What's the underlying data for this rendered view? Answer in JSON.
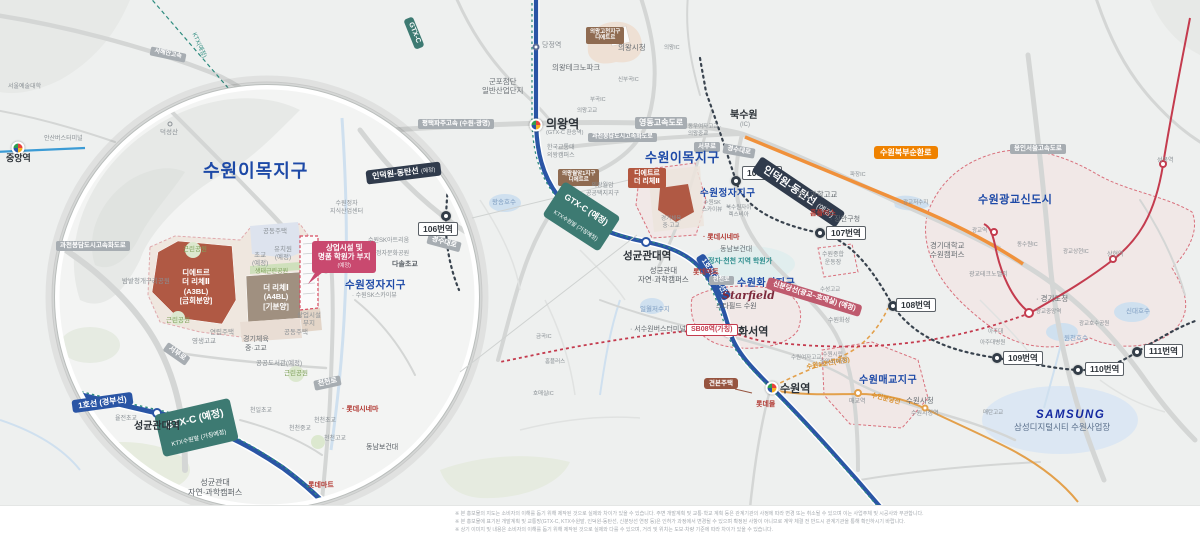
{
  "colors": {
    "accent_blue": "#1d49a7",
    "line1_blue": "#2a55a5",
    "gtx_green": "#3d7a72",
    "indeokwon_navy": "#303b4c",
    "sinbundang_red": "#c43b4e",
    "suin_orange": "#e3a04b",
    "ring_road_orange": "#ef8200",
    "callout_pink": "#c9496f",
    "parcel_red": "#b05944",
    "parcel_tan": "#a09080",
    "samsung_blue": "#1428a0"
  },
  "inset": {
    "title": "수원이목지구",
    "labels": {
      "highway": "과천봉담도시고속화도로",
      "mountain": "덕성산",
      "frog_park": "밤밭청개구리공원",
      "park": "근린공원",
      "eco_park": "생태근린공원",
      "housing": "공동주택",
      "kinder": "유치원\n(예정)",
      "elem": "초교\n(예정)",
      "parcel_a3": "디에트르\n더 리체Ⅱ\n(A3BL)\n[금회분양]",
      "parcel_a4": "더 리체Ⅰ\n(A4BL)\n[기분양]",
      "callout_main": "상업시설 및\n명품 학원가 부지",
      "callout_sub": "(예정)",
      "jeongja_district": "수원정자지구",
      "skyview": "· 수원SK스카이뷰",
      "sk_artrium": "수원SK아트리움",
      "jeongja_park": "정자문화공원",
      "dasol": "다솔초교",
      "knowledge_center": "수원정자\n지식산업센터",
      "row_house": "연립주택",
      "commercial_lot": "상업시설\n부지",
      "library": "공공도서관(예정)",
      "sports_school": "경기체육\n중·고교",
      "yeongsaeng": "영생고교",
      "yuljeon": "율전초교",
      "cheonil": "천일초교",
      "cheoncheon_elem": "천천초교",
      "cheoncheon_mid": "천천중교",
      "cheoncheon_high": "천천고교",
      "lotte_cinema": "· 롯데시네마",
      "dongnam": "동남보건대",
      "lotte_mart": "롯데마트",
      "skku_station": "성균관대역",
      "skku_campus": "성균관대\n자연·과학캠퍼스"
    },
    "boxes": {
      "seobu": "서부로",
      "cheoncheon": "천천로",
      "gyeongsu": "경수대로",
      "st106": "106번역"
    },
    "bands": {
      "line1": "1호선 (경부선)",
      "indeokwon": "인덕원-동탄선",
      "yejeong": "(예정)",
      "gtx1": "GTX-C (예정)",
      "gtx2": "KTX수원발 (가칭예정)"
    }
  },
  "main": {
    "title": "수원이목지구",
    "labels": {
      "gtx_top": "GTX-C",
      "ktx_line": "KTX(예정)",
      "seohaean": "서해안고속",
      "jungang_station": "중앙역",
      "seoul_arts": "서울예술대학",
      "ansan_terminal": "안산버스터미널",
      "pyeongtaek": "평택파주고속 (수원-광명)",
      "dangjeong": "당정역",
      "technopark": "의왕테크노파크",
      "gunpo": "군포첨단\n일반산업단지",
      "uiwang_station": "의왕역",
      "uiwang_station_sub": "(GTX-C 환승역)",
      "uiwang_hall": "의왕시청",
      "gocheon_box": "의왕고천지구\n디에트르",
      "transport_univ": "한국교통대\n의왕캠퍼스",
      "wolam_box": "의왕월암1지구\n디에트르",
      "wolam_district": "의왕월암\n공공택지지구",
      "yeongdong": "영동고속도로",
      "gwacheon_rd": "과천봉담도시고속화도로",
      "buksuwon": "북수원",
      "ic": "(IC)",
      "nw_schools": "동우여자고교 ·\n의왕중교",
      "seobu": "서부로",
      "gyeongsu": "경수대로",
      "bukbu_ring": "수원북부순환로",
      "pajang_ic": "파장IC",
      "uiwang_ic": "의왕IC",
      "sinbugok_ic": "신부곡IC",
      "bugok_ic": "부곡IC",
      "uiwang_high": "의왕고교",
      "wangsong": "왕송호수",
      "wolam_ic": "월암IC",
      "jeongja_district": "수원정자지구",
      "skyview": "수원SK\n스카이뷰",
      "rexvia": "북수원자이\n렉스비아",
      "science_high": "경기과학고교",
      "homeplus": "홈플러스",
      "jangan_gu": "· 장안구청",
      "stadium": "수원종합\n운동장",
      "lotte_cinema": "· 롯데시네마",
      "dongnam": "동남보건대",
      "hagwon_zone": "정자·천천 지역 학원가",
      "riche_box": "디에트르\n더 리체Ⅱ",
      "sports_school": "경기체육\n중·고교",
      "skku_station": "성균관대역",
      "skku_campus": "성균관대\n자연·과학캠퍼스",
      "lotte_mart": "롯데마트",
      "cheoncheon_ro": "천천로",
      "hwaseo_district": "수원화서지구",
      "starfield": "Starfield",
      "starfield_kr": "스타필드 수원",
      "sb08": "SB08역(가칭)",
      "hwaseo_station": "화서역",
      "terminal": "· 서수원버스터미널",
      "ilwol": "일월저수지",
      "geumgok_ic": "금곡IC",
      "homeplus2": "홈플러스",
      "homaesil_ic": "호매실IC",
      "model_house": "견본주택",
      "suwon_station": "수원역",
      "lotte_mall": "롯데몰",
      "suwon_line1": "수원1호선(예정)",
      "suwon_girls": "수원여자고교",
      "city_library": "수원시립\n중앙도서관",
      "maegyo_district": "수원매교지구",
      "maegyo_station": "매교역",
      "suin_line": "수인분당선",
      "cityhall": "수원시청",
      "cityhall_station": "수원시청역",
      "hwaseong": "수원화성",
      "suseong": "수성고교",
      "ajou": "아주대",
      "ajou_hosp": "아주대병원",
      "gyeonggi_hall": "· 경기도청",
      "gj_station": "광교중앙역",
      "lake_park": "광교호수공원",
      "woncheon": "원천호수",
      "sindae": "신대호수",
      "maetan": "매탄고교",
      "gwanggyo_city": "수원광교신도시",
      "gwanggyo_resv": "광교저수지",
      "gwanggyo_st": "광교역",
      "kyonggi_univ": "경기대학교\n수원캠퍼스",
      "dongsuwon_ic": "동수원IC",
      "sanghyeon_ic": "광교상현IC",
      "sanghyeon_st": "상현역",
      "seongbok_st": "성복역",
      "yongin_rd": "용인서울고속도로",
      "techno_valley": "광교테크노밸리"
    },
    "station_boxes": {
      "st106": "106번역",
      "st107": "107번역",
      "st108": "108번역",
      "st109": "109번역",
      "st110": "110번역",
      "st111": "111번역"
    },
    "bands": {
      "line1": "1호선(경부선)",
      "indeokwon": "인덕원-동탄선",
      "yejeong": "(예정)",
      "gtx1": "GTX-C (예정)",
      "gtx2": "KTX수원발 (가칭예정)",
      "sinbundang": "신분당선(광교~호매실) (예정)"
    }
  },
  "samsung": {
    "logo": "SAMSUNG",
    "name": "삼성디지털시티 수원사업장"
  },
  "disclaimer": {
    "line1": "※ 본 홍보물의 지도는 소비자의 이해를 돕기 위해 제작된 것으로 실제와 차이가 있을 수 있습니다. 주변 개발계획 및 교통·학교 계획 등은 관계기관의 사정에 따라 변경 또는 취소될 수 있으며 이는 사업주체 및 시공사와 무관합니다.",
    "line2": "※ 본 홍보물에 표기된 개발계획 및 교통망(GTX-C, KTX수원발, 인덕원-동탄선, 신분당선 연장 등)은 인허가 과정에서 변경될 수 있으며 확정된 사항이 아니므로 계약 체결 전 반드시 관계기관을 통해 확인하시기 바랍니다.",
    "line3": "※ 상기 이미지 및 내용은 소비자의 이해를 돕기 위해 제작된 것으로 실제와 다를 수 있으며, 거리 및 위치는 도보·차량 기준에 따라 차이가 있을 수 있습니다."
  }
}
